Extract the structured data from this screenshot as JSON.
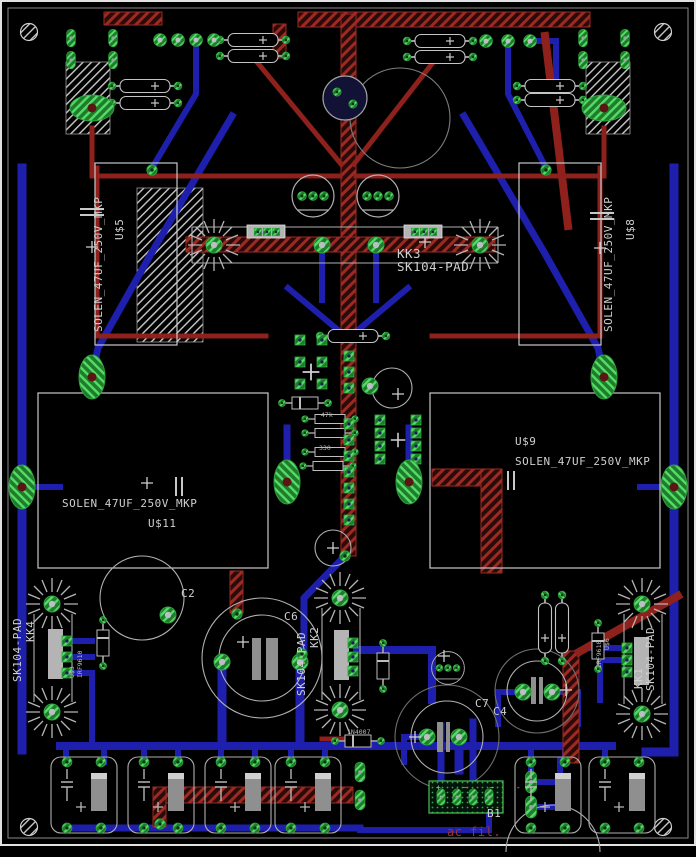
{
  "board": {
    "colors": {
      "background": "#000000",
      "top_copper_red": "#8e211c",
      "bottom_copper_blue": "#1f1fae",
      "pad_green": "#2fa43e",
      "silkscreen": "#c8c8c8",
      "note_red": "#a2342a"
    },
    "labels": {
      "u5_part": "SOLEN_47UF_250V_MKP",
      "u5_ref": "U$5",
      "u8_part": "SOLEN_47UF_250V_MKP",
      "u8_ref": "U$8",
      "u9_ref": "U$9",
      "u9_part": "SOLEN_47UF_250V_MKP",
      "u11_part": "SOLEN_47UF_250V_MKP",
      "u11_ref": "U$11",
      "kk3_ref": "KK3",
      "kk3_part": "SK104-PAD",
      "kk4_part": "SK104-PAD",
      "kk4_ref": "KK4",
      "kk2_part": "SK104-PAD",
      "kk2_ref": "KK2",
      "kk1_ref": "KK1",
      "kk1_part": "SK104-PAD",
      "c2_ref": "C2",
      "c6_ref": "C6",
      "c7_ref": "C7",
      "c4_ref": "C4",
      "b1_ref": "B1",
      "b1_marks": "+ ~ ~ -",
      "ac_note": "ac fil.",
      "d1_part": "1N4007",
      "r1_val": "47k",
      "r2_val": "330",
      "q1_ref": "U$3",
      "q1_part": "IRF9610",
      "q2_ref": "U$6",
      "q2_part": "IRF9610"
    }
  }
}
